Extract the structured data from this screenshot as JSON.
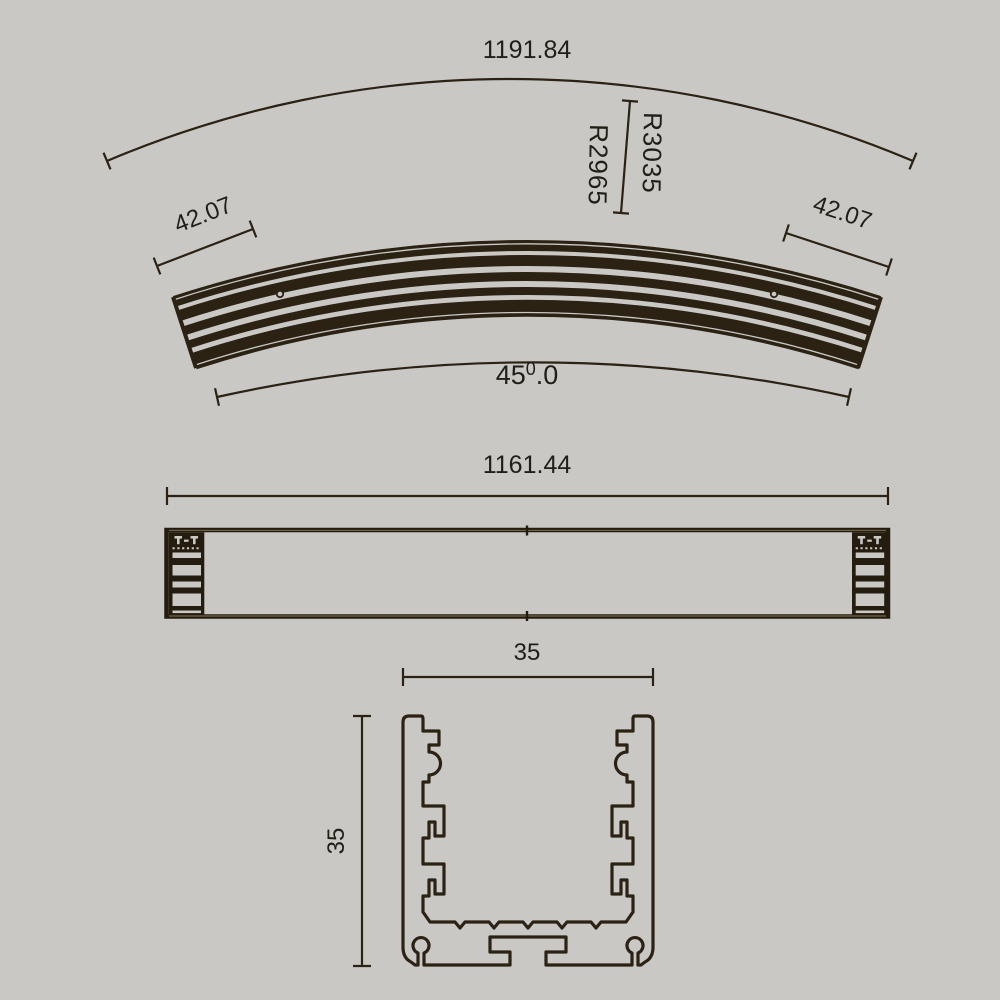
{
  "palette": {
    "background": "#c9c8c5",
    "ink": "#2b2214",
    "text": "#211e16"
  },
  "curved_view": {
    "arc_length": "1191.84",
    "radius_outer": "R3035",
    "radius_inner": "R2965",
    "end_width_left": "42.07",
    "end_width_right": "42.07",
    "angle_base": "45",
    "angle_sup": "0",
    "angle_frac": ".0"
  },
  "side_view": {
    "length": "1161.44"
  },
  "section_view": {
    "width": "35",
    "height": "35"
  }
}
